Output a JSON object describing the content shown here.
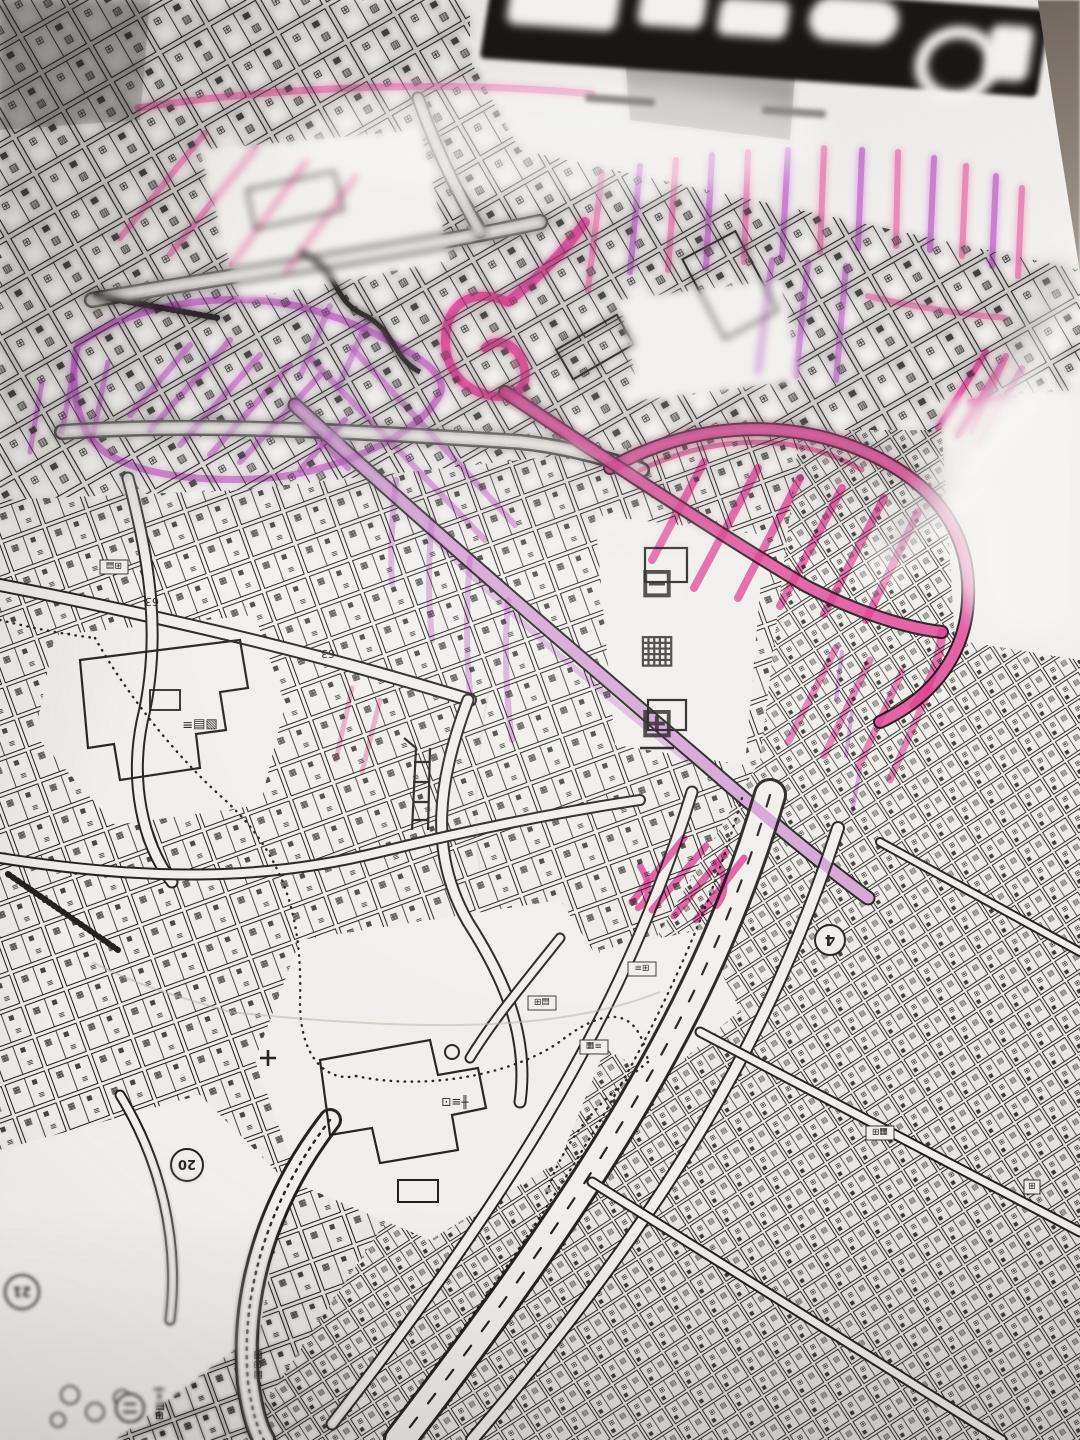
{
  "photo": {
    "paper_color": "#f1efec",
    "ink_color": "#211f1d",
    "background_corner_color": "#6f665b",
    "marker_colors": {
      "pink": "#ea3897",
      "deep_pink": "#d4226f",
      "light_pink": "#ee6fae",
      "violet": "#c35fd0",
      "magenta": "#c24fc6"
    }
  },
  "title_block": {
    "background": "#191715"
  },
  "labels": {
    "route_badge_4": "4",
    "stop_badge_20": "20",
    "stop_badge_21": "21",
    "block_63_a": "63",
    "block_63_b": "63",
    "big_vertical_top": "⊟",
    "big_vertical_mid": "▦",
    "big_vertical_bottom": "⊞",
    "school": "╫≡⊡",
    "facility_left": "▧▤≡",
    "box_1": "⊞▤",
    "box_2": "▤⊞",
    "box_3": "≡▦",
    "box_4": "⊞≡",
    "box_5": "▦⊞",
    "box_6": "⊞",
    "column_1": "⊞▤≡╫",
    "column_2": "▤⊞▦"
  },
  "pattern_glyphs": {
    "dense_a": "⊞",
    "dense_b": "▤",
    "med_a": "▦",
    "med_b": "≡",
    "coarse_a": "⊞",
    "coarse_b": "▨"
  }
}
